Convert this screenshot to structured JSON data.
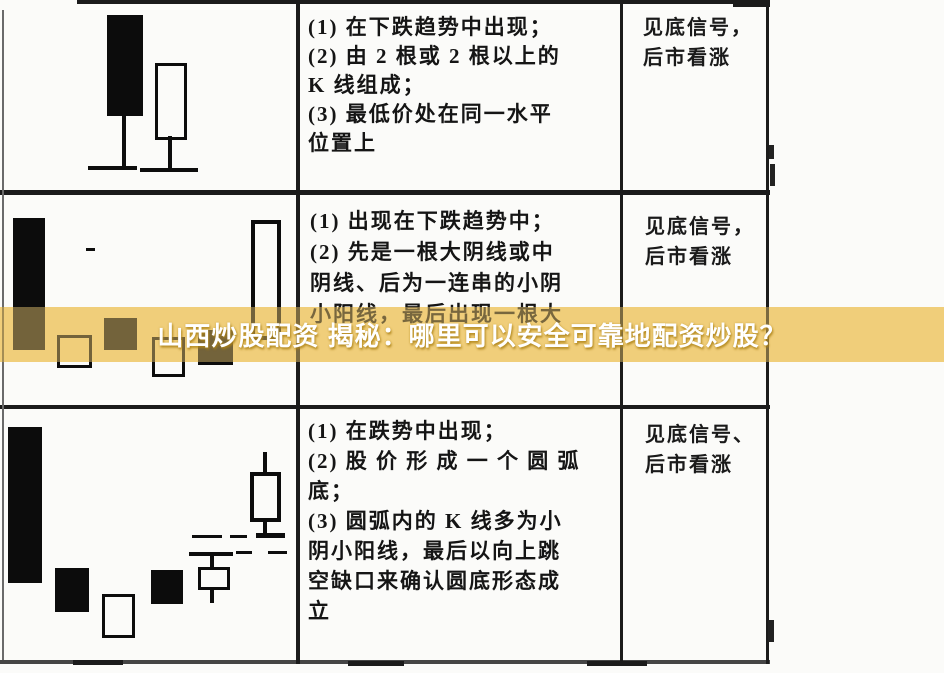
{
  "banner": {
    "text": "山西炒股配资 揭秘：哪里可以安全可靠地配资炒股？",
    "bg_color": "#f2d17c",
    "text_color": "#ffffff"
  },
  "table": {
    "rows": [
      {
        "description_lines": [
          "(1) 在下跌趋势中出现；",
          "(2) 由 2 根或 2 根以上的",
          "K 线组成；",
          "(3) 最低价处在同一水平",
          "位置上"
        ],
        "signal_lines": [
          "见底信号，",
          "后市看涨"
        ],
        "pattern": {
          "type": "candlestick",
          "candles": [
            {
              "fill": "solid",
              "x": 107,
              "y": 11,
              "w": 36,
              "h": 101
            },
            {
              "fill": "hollow",
              "x": 155,
              "y": 59,
              "w": 32,
              "h": 77,
              "b": 3
            }
          ],
          "marks": [
            {
              "x": 122,
              "y": 110,
              "w": 4,
              "h": 54
            },
            {
              "x": 88,
              "y": 162,
              "w": 49,
              "h": 4
            },
            {
              "x": 168,
              "y": 132,
              "w": 4,
              "h": 34
            },
            {
              "x": 140,
              "y": 164,
              "w": 58,
              "h": 4
            }
          ]
        }
      },
      {
        "description_lines": [
          "(1) 出现在下跌趋势中；",
          "(2) 先是一根大阴线或中",
          "阴线、后为一连串的小阴",
          "小阳线，最后出现一根大"
        ],
        "signal_lines": [
          "见底信号，",
          "后市看涨"
        ],
        "pattern": {
          "type": "candlestick",
          "candles": [
            {
              "fill": "solid",
              "x": 13,
              "y": 20,
              "w": 32,
              "h": 132
            },
            {
              "fill": "hollow",
              "x": 57,
              "y": 137,
              "w": 35,
              "h": 33,
              "b": 3
            },
            {
              "fill": "solid",
              "x": 104,
              "y": 120,
              "w": 33,
              "h": 32
            },
            {
              "fill": "hollow",
              "x": 152,
              "y": 139,
              "w": 33,
              "h": 40,
              "b": 3
            },
            {
              "fill": "solid",
              "x": 198,
              "y": 132,
              "w": 35,
              "h": 35
            },
            {
              "fill": "hollow",
              "x": 251,
              "y": 22,
              "w": 30,
              "h": 120,
              "b": 4
            }
          ],
          "marks": [
            {
              "x": 86,
              "y": 50,
              "w": 9,
              "h": 3
            }
          ]
        }
      },
      {
        "description_lines": [
          "(1) 在跌势中出现；",
          "(2) 股 价 形 成 一 个 圆 弧",
          "底；",
          "(3) 圆弧内的 K 线多为小",
          "阴小阳线，最后以向上跳",
          "空缺口来确认圆底形态成",
          "立"
        ],
        "signal_lines": [
          "见底信号、",
          "后市看涨"
        ],
        "pattern": {
          "type": "candlestick",
          "candles": [
            {
              "fill": "solid",
              "x": 8,
              "y": 17,
              "w": 34,
              "h": 156
            },
            {
              "fill": "solid",
              "x": 55,
              "y": 158,
              "w": 34,
              "h": 44
            },
            {
              "fill": "hollow",
              "x": 102,
              "y": 184,
              "w": 33,
              "h": 44,
              "b": 3
            },
            {
              "fill": "solid",
              "x": 151,
              "y": 160,
              "w": 32,
              "h": 34
            },
            {
              "fill": "hollow",
              "x": 198,
              "y": 157,
              "w": 32,
              "h": 23,
              "b": 3
            },
            {
              "fill": "hollow",
              "x": 250,
              "y": 62,
              "w": 31,
              "h": 50,
              "b": 4
            }
          ],
          "marks": [
            {
              "x": 189,
              "y": 142,
              "w": 44,
              "h": 4
            },
            {
              "x": 210,
              "y": 146,
              "w": 4,
              "h": 11
            },
            {
              "x": 210,
              "y": 180,
              "w": 4,
              "h": 13
            },
            {
              "x": 263,
              "y": 42,
              "w": 4,
              "h": 20
            },
            {
              "x": 263,
              "y": 112,
              "w": 4,
              "h": 11
            },
            {
              "x": 256,
              "y": 123,
              "w": 29,
              "h": 5
            },
            {
              "x": 192,
              "y": 125,
              "w": 30,
              "h": 3
            },
            {
              "x": 230,
              "y": 125,
              "w": 17,
              "h": 3
            },
            {
              "x": 236,
              "y": 141,
              "w": 16,
              "h": 3
            },
            {
              "x": 268,
              "y": 141,
              "w": 19,
              "h": 3
            }
          ]
        }
      }
    ]
  }
}
